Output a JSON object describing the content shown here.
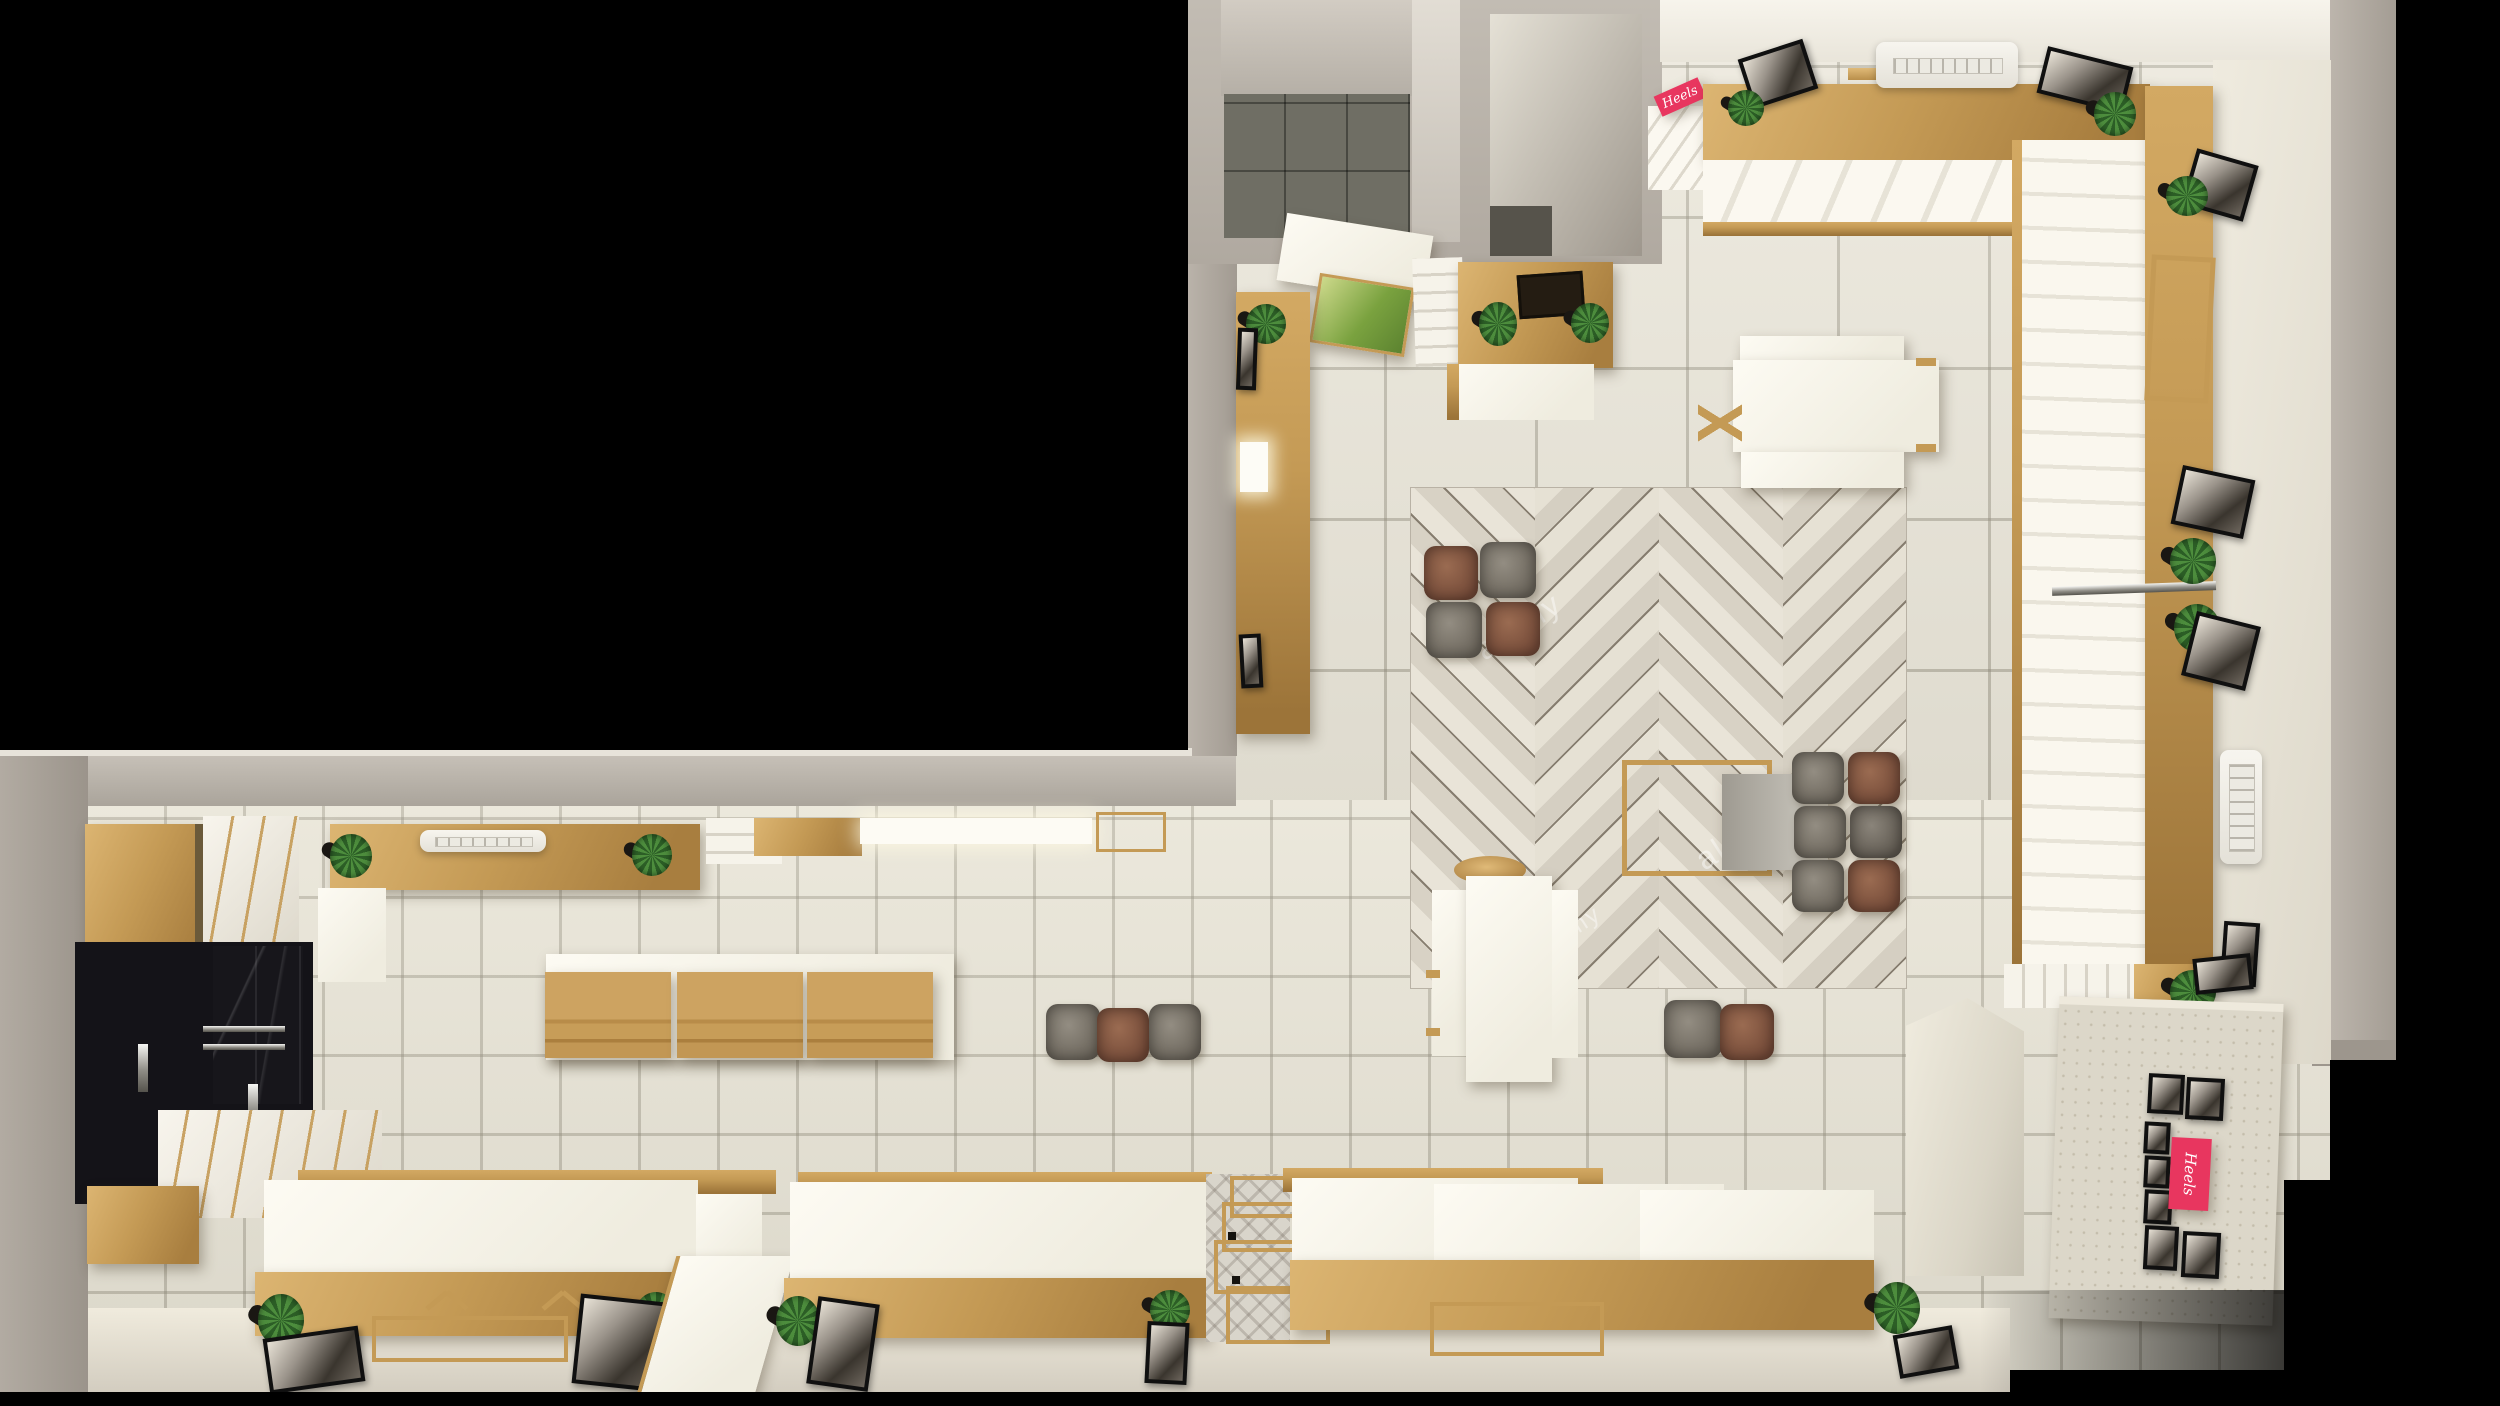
{
  "scene": {
    "description": "Bird's-eye 3D render of an L-shaped retail shoe store interior surrounded by black background",
    "view": "top-down architectural visualization"
  },
  "signs": {
    "heels_small": "Heels",
    "heels_poster": "Heels"
  },
  "watermark": {
    "text": "alamy"
  },
  "palette": {
    "background": "#000000",
    "gold_fixture": "#c49a55",
    "floor_tile": "#eae6d9",
    "wall_gray": "#b3aca3",
    "rug_wood": "#ddd7ca",
    "accent_pink": "#e8365f",
    "fixture_white": "#f6f3ea",
    "ottoman_brown": "#8a5d49",
    "ottoman_gray": "#8b857c",
    "plant_green": "#4d8d3d",
    "backroom_tile": "#6f6e64"
  },
  "inventory": [
    "herringbone wood area rug",
    "cube ottomans (brown and gray)",
    "gold display counters and risers",
    "white display tables with gold fascia",
    "white wall shelving bays",
    "framed black-and-white photographs",
    "potted plants",
    "ceiling air-conditioning units",
    "gold cash desk with plants",
    "back rooms with dark tile",
    "gold nesting display racks",
    "travertine gallery wall with pink Heels poster",
    "black wardrobe cabinets with chrome rails"
  ]
}
